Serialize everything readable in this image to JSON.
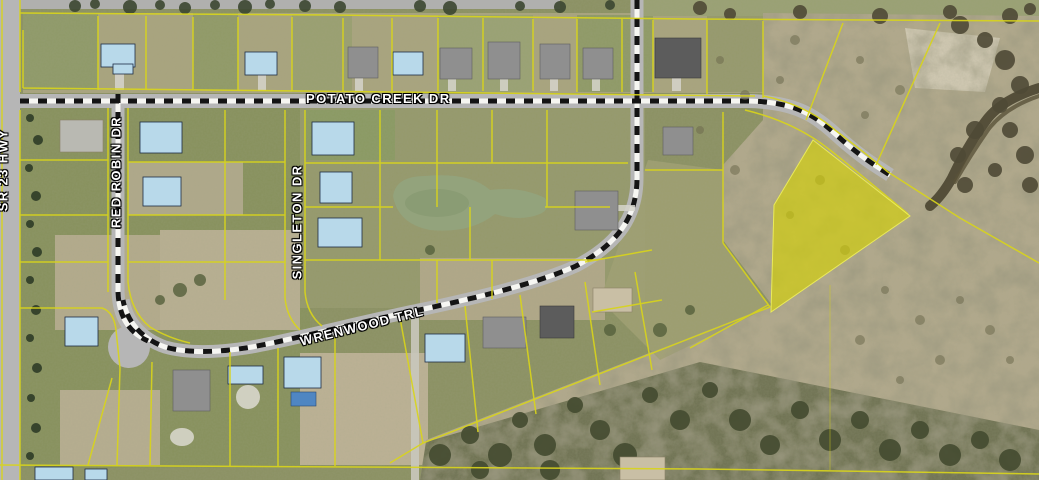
{
  "map": {
    "description": "Aerial parcel map with highlighted lot",
    "streets": {
      "potato_creek": "POTATO CREEK DR",
      "red_robin": "RED ROBIN DR",
      "singleton": "SINGLETON DR",
      "wrenwood": "WRENWOOD TRL",
      "highway": "SR 23 HWY"
    },
    "colors": {
      "parcel_line": "#d8d41c",
      "highlight_fill": "#d6d400",
      "road_pavement": "#b6b6b6",
      "centerline_white": "#f6f6f2",
      "centerline_black": "#141414"
    }
  }
}
